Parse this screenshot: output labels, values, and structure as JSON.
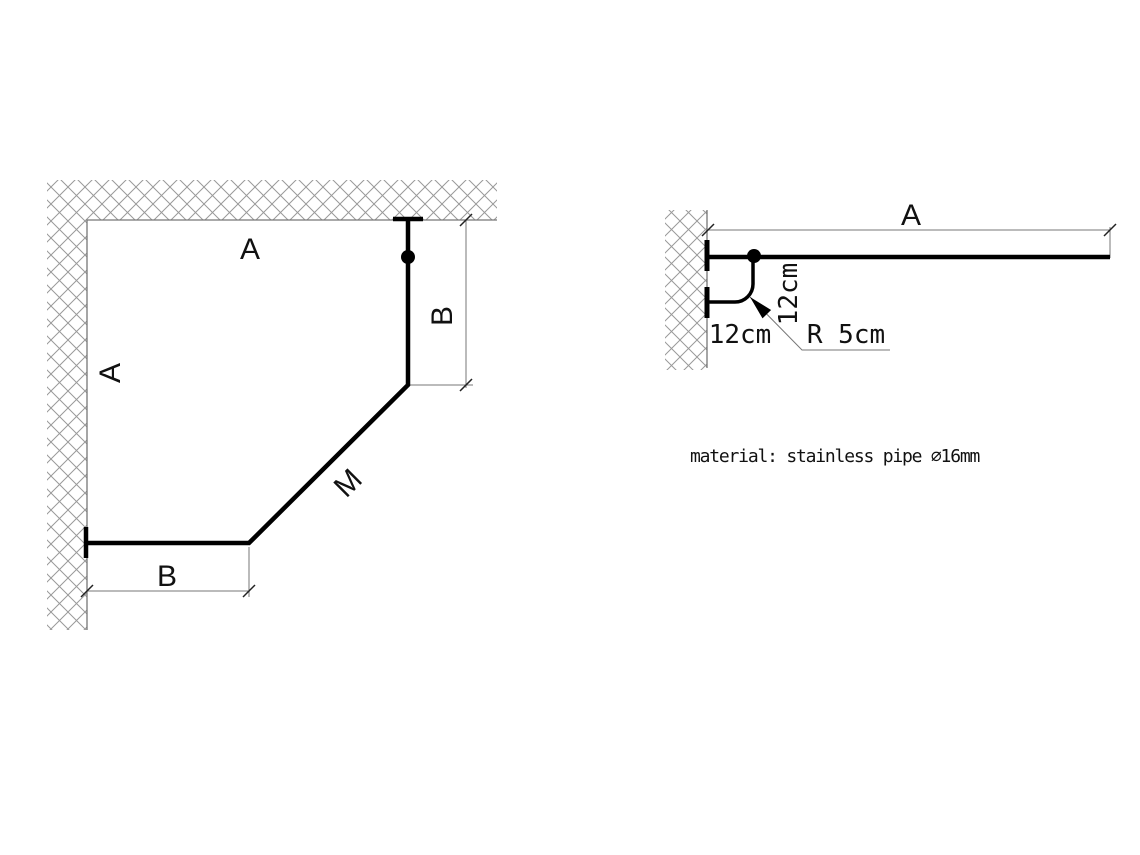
{
  "canvas": {
    "background": "#ffffff"
  },
  "colors": {
    "pipe": "#000000",
    "thin_line": "#777777",
    "hatch_line": "#999999",
    "tick": "#222222",
    "text": "#111111"
  },
  "plan_view": {
    "labels": {
      "top_wall_segment": "A",
      "left_wall_segment": "A",
      "right_offset_dim": "B",
      "bottom_offset_dim": "B",
      "diagonal_segment": "M"
    }
  },
  "side_view": {
    "labels": {
      "length_dim": "A",
      "bracket_vertical_dim": "12cm",
      "bracket_horizontal_dim": "12cm",
      "bend_radius": "R 5cm"
    }
  },
  "notes": {
    "material": "material: stainless pipe ∅16mm"
  }
}
